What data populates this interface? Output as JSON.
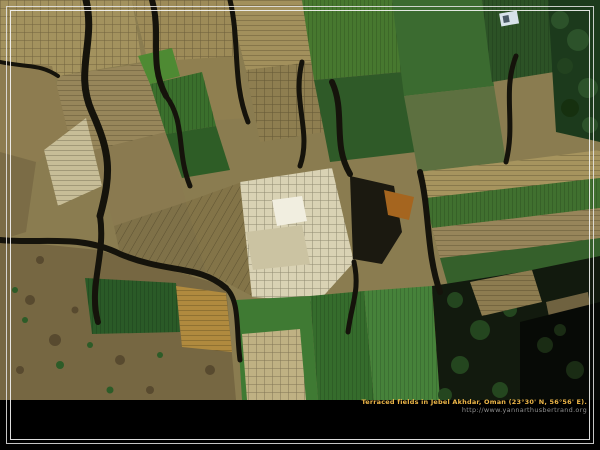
{
  "window": {
    "width": 600,
    "height": 450,
    "background": "#000000"
  },
  "photo": {
    "subject": "Aerial view of terraced agricultural fields",
    "palette": {
      "tan_terrace": "#a3925e",
      "khaki_plot": "#8f7f50",
      "pale_terrace": "#d9d2b4",
      "white_plot": "#f1eee0",
      "olive_green": "#3a6f2c",
      "bright_green": "#46823a",
      "dark_green_trees": "#1c3a1c",
      "gold_field": "#b08a3e",
      "rust_field": "#a86a28",
      "rock_slope": "#766742",
      "wadi_shadow": "#15130b",
      "corner_shadow": "#070a06"
    }
  },
  "frame": {
    "line_color": "#ededed"
  },
  "caption": {
    "line1": "Terraced fields in Jebel Akhdar, Oman (23°30' N, 56°56' E).",
    "line2": "http://www.yannarthusbertrand.org",
    "line1_color": "#edb648",
    "line2_color": "#8f8f8f"
  }
}
